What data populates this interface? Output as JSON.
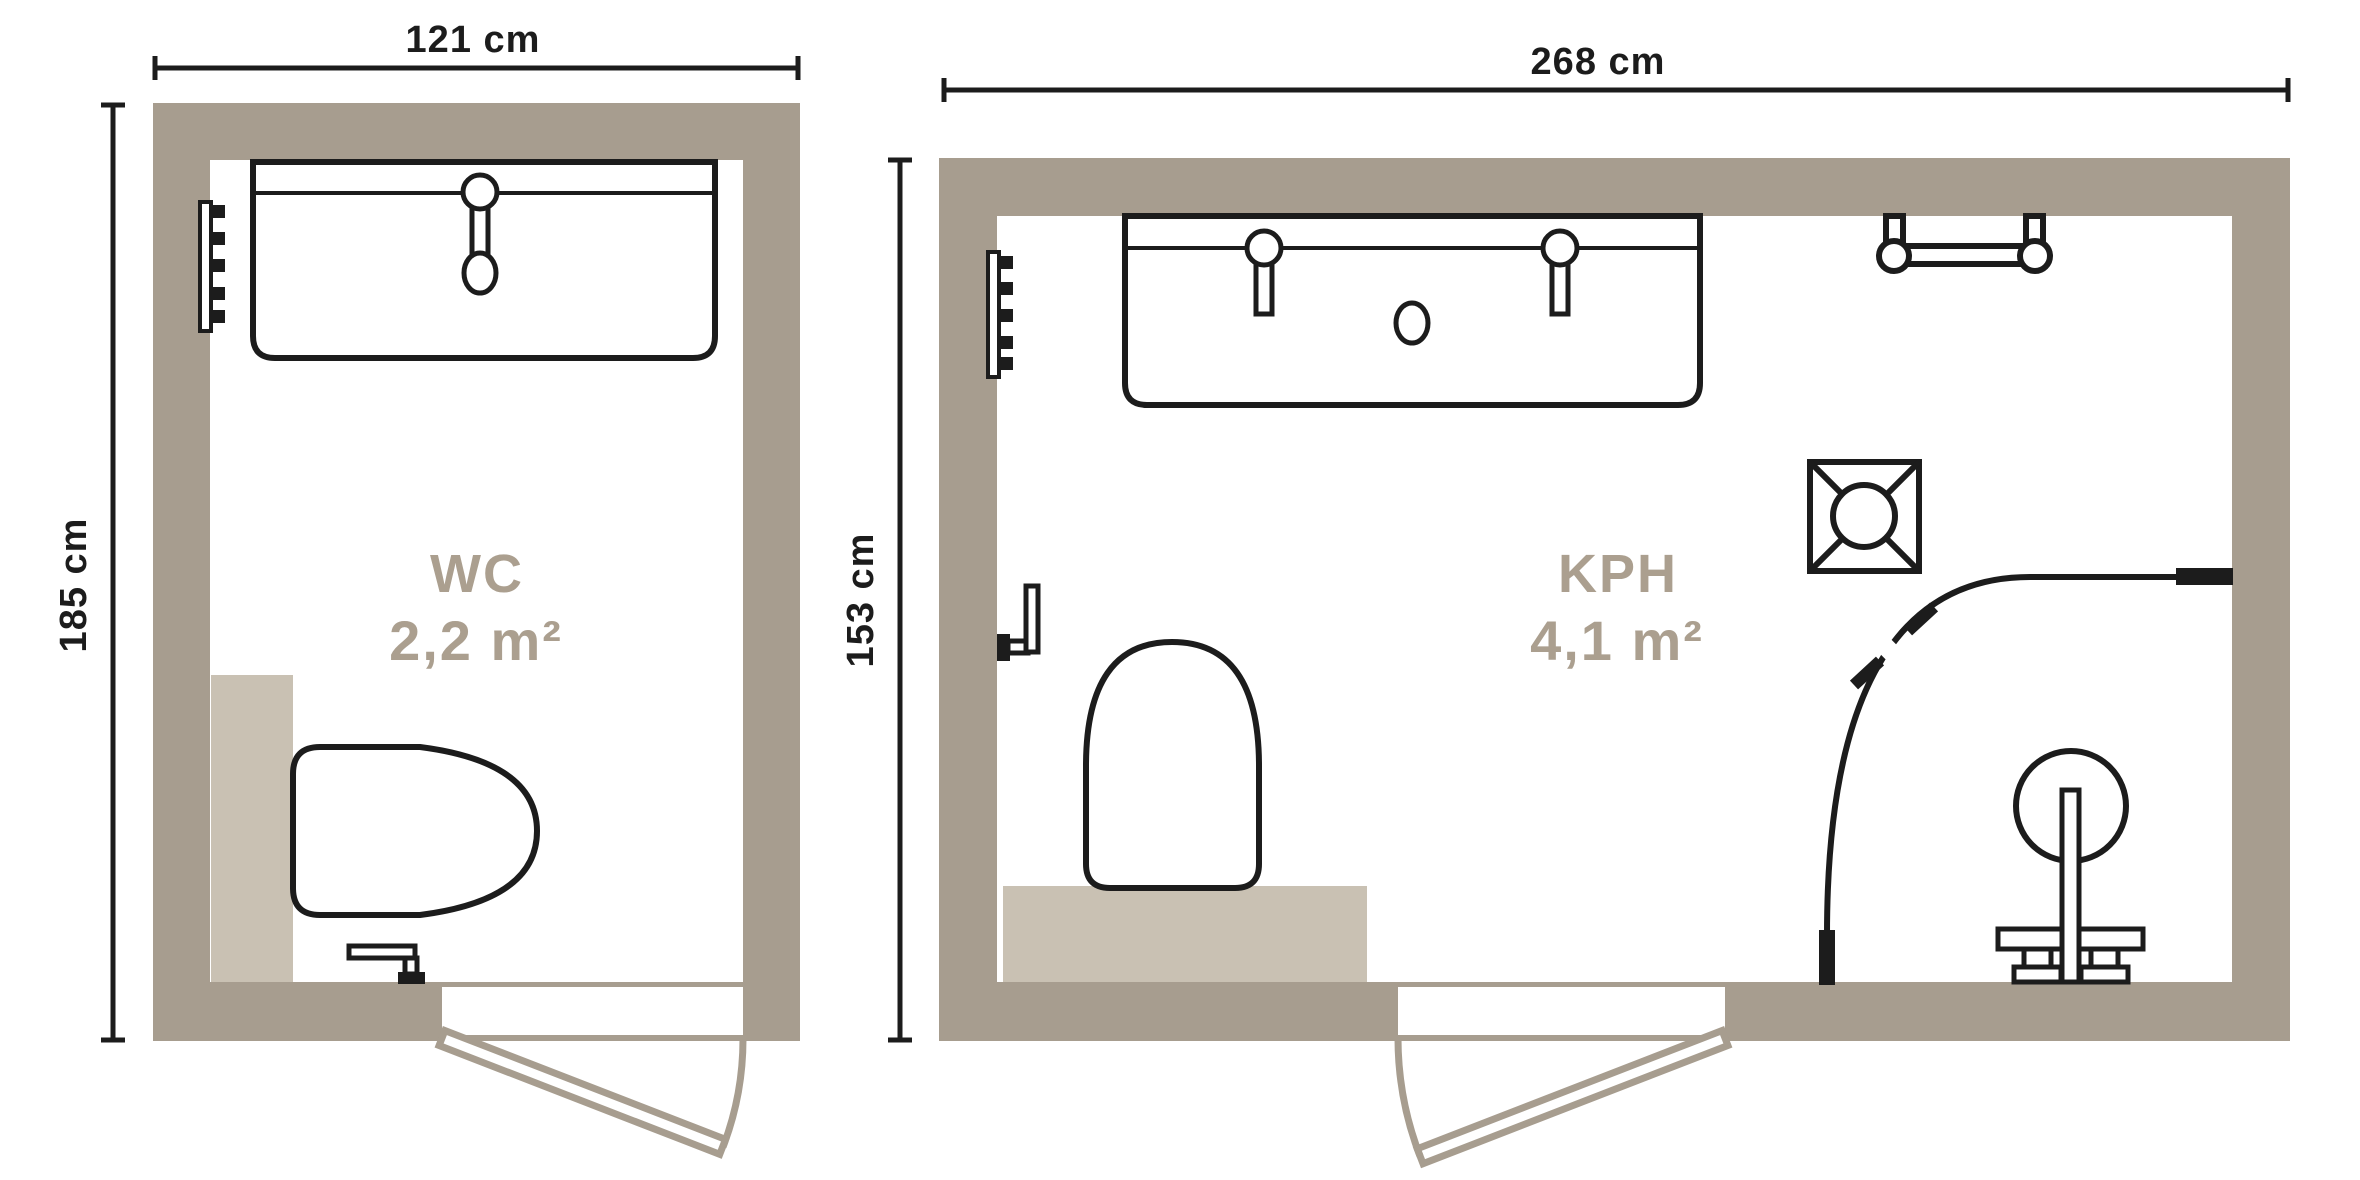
{
  "title": "bathroom-floorplans",
  "colors": {
    "wall": "#a79d8f",
    "shower_block": "#c9c1b3",
    "line": "#1c1c1c",
    "label": "#ab9f8f",
    "floor": "#ffffff"
  },
  "left_plan": {
    "room_label": "WC",
    "room_area": "2,2 m²",
    "width_dim": "121 cm",
    "height_dim": "185 cm",
    "fixtures": [
      "vanity-sink",
      "faucet",
      "drain",
      "towel-radiator",
      "shower-block",
      "toilet",
      "toilet-paper-holder",
      "door-swing"
    ]
  },
  "right_plan": {
    "room_label": "KPH",
    "room_area": "4,1 m²",
    "width_dim": "268 cm",
    "height_dim": "153 cm",
    "fixtures": [
      "vanity-sink-double",
      "faucet",
      "faucet",
      "drain",
      "towel-radiator",
      "toilet-paper-holder",
      "toilet",
      "shower-block",
      "ceiling-vent",
      "towel-bar",
      "shower-curtain-rail",
      "shower-column",
      "door-swing"
    ]
  }
}
